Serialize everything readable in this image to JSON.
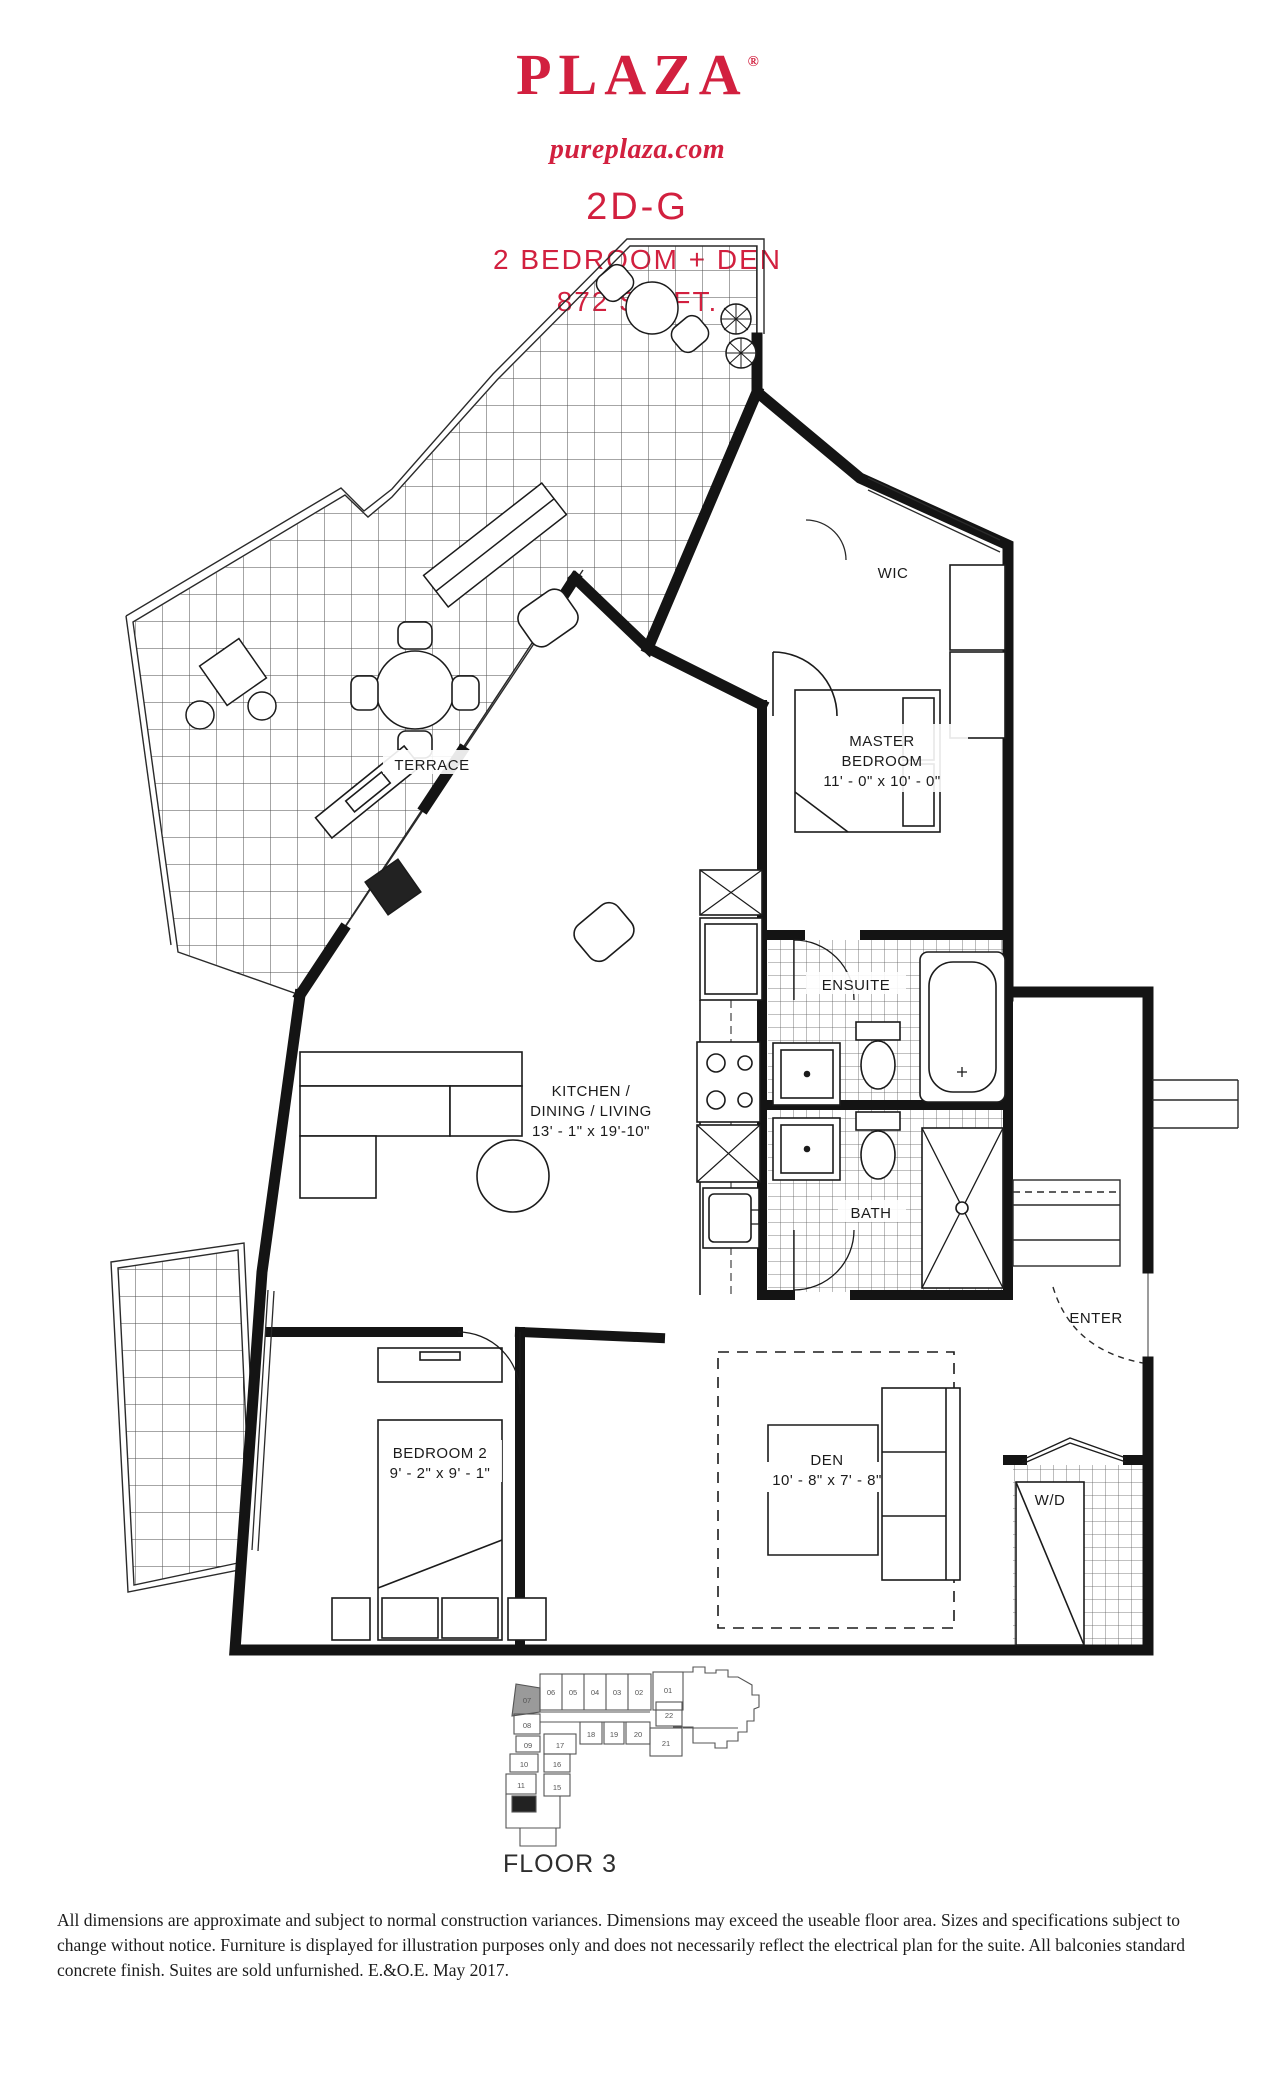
{
  "brand": {
    "logo": "PLAZA",
    "registered": "®",
    "website": "pureplaza.com",
    "accent_color": "#d2203f"
  },
  "plan_header": {
    "unit_code": "2D-G",
    "unit_type": "2 BEDROOM + DEN",
    "area": "872 SQ.FT."
  },
  "rooms": {
    "wic": "WIC",
    "master_l1": "MASTER",
    "master_l2": "BEDROOM",
    "master_dims": "11' - 0\" x 10' - 0\"",
    "terrace": "TERRACE",
    "ensuite": "ENSUITE",
    "kitchen_l1": "KITCHEN /",
    "kitchen_l2": "DINING / LIVING",
    "kitchen_dims": "13' - 1\" x 19'-10\"",
    "bath": "BATH",
    "enter": "ENTER",
    "bedroom2_l1": "BEDROOM 2",
    "bedroom2_dims": "9' - 2\" x 9' - 1\"",
    "den_l1": "DEN",
    "den_dims": "10' - 8\" x 7' - 8\"",
    "wd": "W/D"
  },
  "keyplan": {
    "floor_label": "FLOOR 3",
    "highlighted_unit": "07",
    "units": [
      {
        "label": "06"
      },
      {
        "label": "05"
      },
      {
        "label": "04"
      },
      {
        "label": "03"
      },
      {
        "label": "02"
      },
      {
        "label": "01"
      },
      {
        "label": "07"
      },
      {
        "label": "08"
      },
      {
        "label": "09"
      },
      {
        "label": "10"
      },
      {
        "label": "11"
      },
      {
        "label": "17"
      },
      {
        "label": "16"
      },
      {
        "label": "15"
      },
      {
        "label": "18"
      },
      {
        "label": "19"
      },
      {
        "label": "20"
      },
      {
        "label": "22"
      },
      {
        "label": "21"
      }
    ]
  },
  "disclaimer": "All dimensions are approximate and subject to normal construction variances. Dimensions may exceed the useable floor area. Sizes and specifications subject to change without notice. Furniture is displayed for illustration purposes only and does not necessarily reflect the electrical plan for the suite. All balconies standard concrete finish. Suites are sold unfurnished. E.&O.E. May 2017."
}
